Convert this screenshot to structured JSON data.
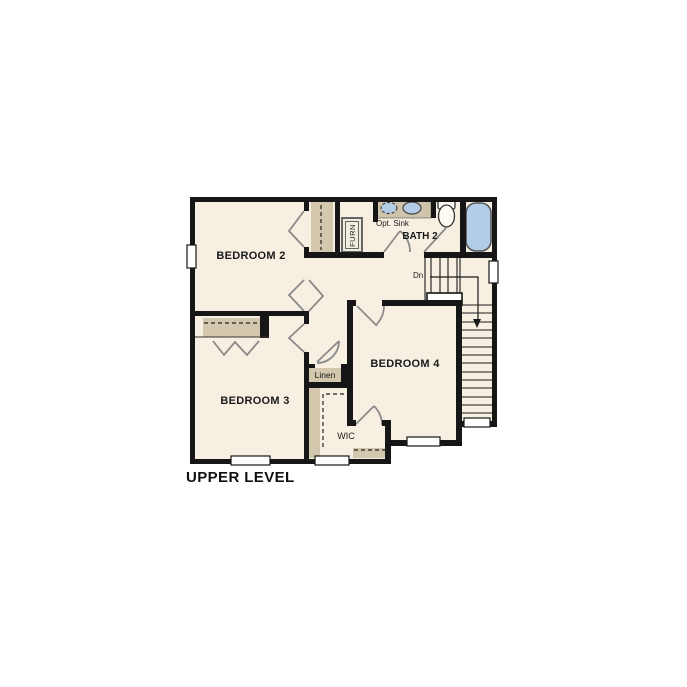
{
  "title": "UPPER LEVEL",
  "plan": {
    "rooms": {
      "bedroom2": "BEDROOM 2",
      "bedroom3": "BEDROOM 3",
      "bedroom4": "BEDROOM 4",
      "bath2": "BATH 2"
    },
    "labels": {
      "opt_sink": "Opt. Sink",
      "furnace": "FURN",
      "stairs_down": "Dn",
      "linen": "Linen",
      "wic": "WIC"
    },
    "colors": {
      "floor_fill": "#f7f0e2",
      "casework_tan": "#d3c7ad",
      "fixture_blue": "#b3cde8",
      "wall_black": "#161616",
      "door_swing_gray": "#8a8a8a"
    }
  }
}
